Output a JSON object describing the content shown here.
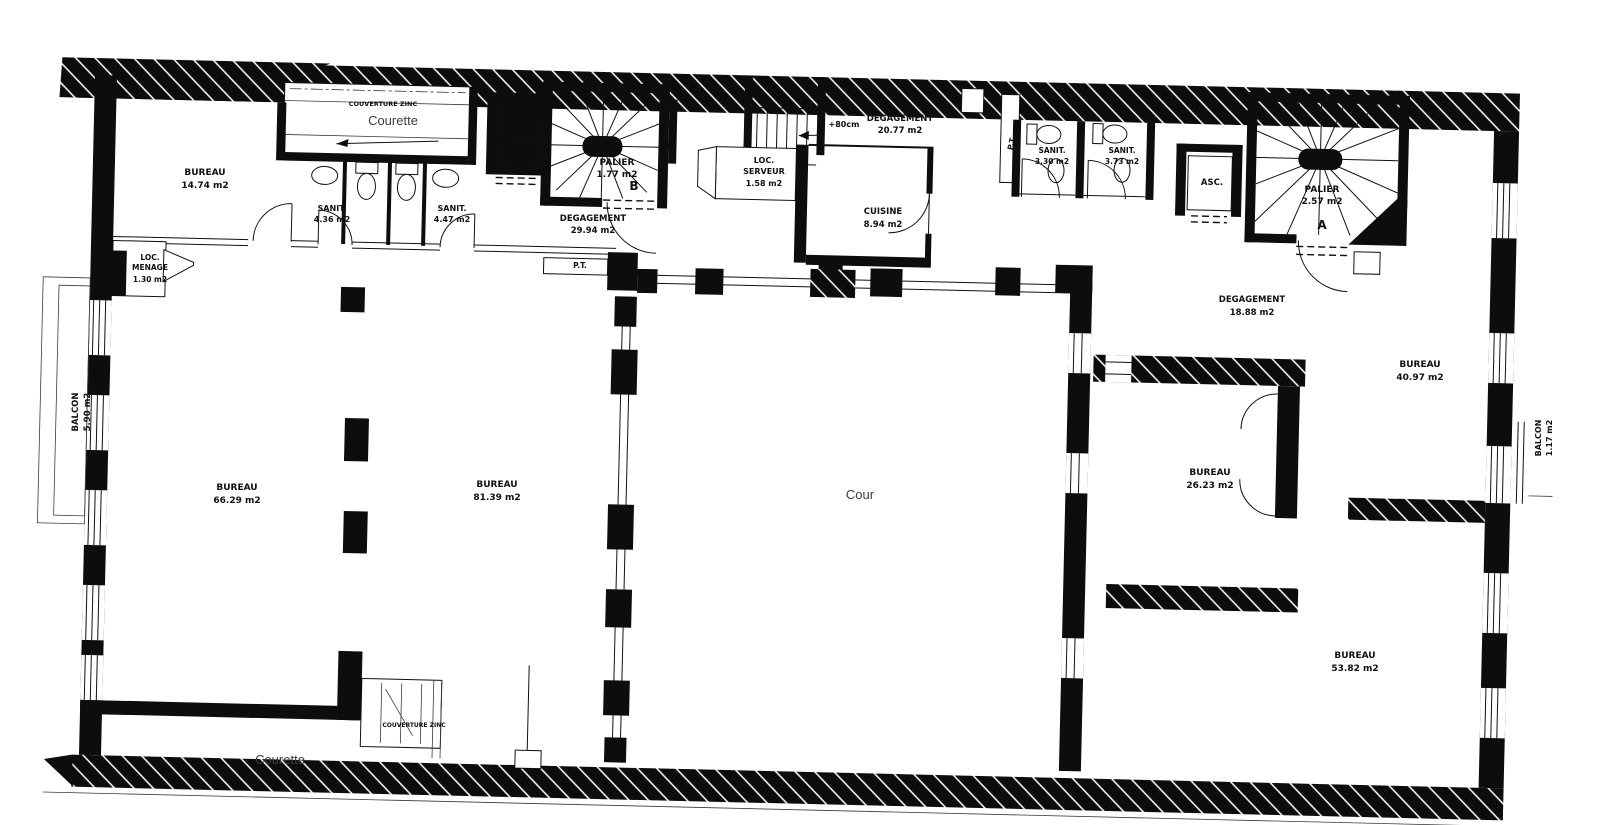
{
  "colors": {
    "ink": "#0d0d0d",
    "paper": "#ffffff",
    "soft_gray": "#3d3d3d"
  },
  "labels": [
    {
      "id": "couverture-top",
      "lines": [
        "COUVERTURE ZINC"
      ]
    },
    {
      "id": "courette-top",
      "lines": [
        "Courette"
      ]
    },
    {
      "id": "bureau-nw",
      "lines": [
        "BUREAU",
        "14.74 m2"
      ]
    },
    {
      "id": "sanit-1",
      "lines": [
        "SANIT.",
        "4.36 m2"
      ]
    },
    {
      "id": "sanit-2",
      "lines": [
        "SANIT.",
        "4.47 m2"
      ]
    },
    {
      "id": "asc-left",
      "lines": [
        "Asc."
      ]
    },
    {
      "id": "palier-b",
      "lines": [
        "PALIER",
        "1.77 m2"
      ]
    },
    {
      "id": "stair-b-letter",
      "lines": [
        "B"
      ]
    },
    {
      "id": "degagement-b",
      "lines": [
        "DEGAGEMENT",
        "29.94 m2"
      ]
    },
    {
      "id": "loc-menage",
      "lines": [
        "LOC.",
        "MENAGE",
        "1.30 m2"
      ]
    },
    {
      "id": "pt-center",
      "lines": [
        "P.T."
      ]
    },
    {
      "id": "stair-height",
      "lines": [
        "+80cm"
      ]
    },
    {
      "id": "degagement-top",
      "lines": [
        "DEGAGEMENT",
        "20.77 m2"
      ]
    },
    {
      "id": "loc-serveur",
      "lines": [
        "LOC.",
        "SERVEUR",
        "1.58 m2"
      ]
    },
    {
      "id": "cuisine",
      "lines": [
        "CUISINE",
        "8.94 m2"
      ]
    },
    {
      "id": "pt-right",
      "lines": [
        "P.T."
      ]
    },
    {
      "id": "sanit-3",
      "lines": [
        "SANIT.",
        "3.30 m2"
      ]
    },
    {
      "id": "sanit-4",
      "lines": [
        "SANIT.",
        "3.73 m2"
      ]
    },
    {
      "id": "asc-right",
      "lines": [
        "ASC."
      ]
    },
    {
      "id": "palier-a",
      "lines": [
        "PALIER",
        "2.57 m2"
      ]
    },
    {
      "id": "stair-a-letter",
      "lines": [
        "A"
      ]
    },
    {
      "id": "balcon-left",
      "lines": [
        "BALCON",
        "5.90 m2"
      ]
    },
    {
      "id": "bureau-w",
      "lines": [
        "BUREAU",
        "66.29 m2"
      ]
    },
    {
      "id": "bureau-c",
      "lines": [
        "BUREAU",
        "81.39 m2"
      ]
    },
    {
      "id": "cour",
      "lines": [
        "Cour"
      ]
    },
    {
      "id": "degagement-e",
      "lines": [
        "DEGAGEMENT",
        "18.88 m2"
      ]
    },
    {
      "id": "bureau-ne",
      "lines": [
        "BUREAU",
        "40.97 m2"
      ]
    },
    {
      "id": "bureau-e",
      "lines": [
        "BUREAU",
        "26.23 m2"
      ]
    },
    {
      "id": "bureau-se",
      "lines": [
        "BUREAU",
        "53.82 m2"
      ]
    },
    {
      "id": "balcon-right",
      "lines": [
        "BALCON",
        "1.17 m2"
      ]
    },
    {
      "id": "courette-bottom",
      "lines": [
        "Courette"
      ]
    },
    {
      "id": "couverture-bottom",
      "lines": [
        "COUVERTURE ZINC"
      ]
    }
  ]
}
